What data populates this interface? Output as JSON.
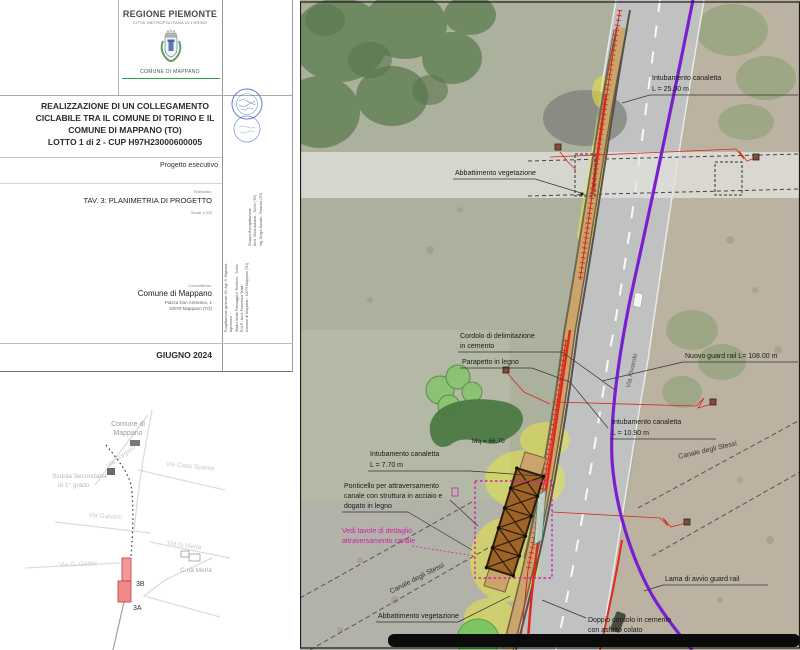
{
  "header": {
    "region": "REGIONE PIEMONTE",
    "metro": "CITTA' METROPOLITANA DI TORINO",
    "comune": "COMUNE DI MAPPANO"
  },
  "title": {
    "line1": "REALIZZAZIONE DI UN COLLEGAMENTO",
    "line2": "CICLABILE TRA IL COMUNE DI TORINO E IL",
    "line3": "COMUNE DI MAPPANO (TO)",
    "line4": "LOTTO 1 di 2 - CUP H97H23000600005",
    "phase": "Progetto esecutivo"
  },
  "elaborato": {
    "label": "Elaborato:",
    "value": "TAV. 3: PLANIMETRIA DI PROGETTO",
    "scale": "Scala 1:200"
  },
  "designers": {
    "right_block": "Gruppo di progettazione:\nArch. Silvia Adriano - Torino (TO)\nIng. Sergio Donato - Rivarolo (TO)",
    "left_block": "Progettazione generale: Dr. Agr. S. Mignone - Agronomo\nStudio Verde Paesaggio e Territorio - Torino\nR.U.P.: Arch. Francesca Testa\nComune di Mappano - 10079 Mappano (TO)"
  },
  "committente": {
    "label": "Committente:",
    "name": "Comune di Mappano",
    "address1": "Piazza Don Amerano, 1",
    "address2": "10079 Mappano (TO)"
  },
  "date": "GIUGNO 2024",
  "minimap": {
    "comune_1": "Comune di",
    "comune_2": "Mappano",
    "scuola_1": "Scuola Secondaria",
    "scuola_2": "di 1° grado",
    "via_borgaro": "Via Borgaro",
    "via_case_sparse": "Via Case Sparse",
    "via_galvani": "Via Galvani",
    "via_la_merla": "Via la Merla",
    "cna_merla": "C.na Merla",
    "via_galilei": "Via G. Galilei",
    "seg_3b": "3B",
    "seg_3a": "3A"
  },
  "plan": {
    "labels": {
      "intub25_1": "Intubamento canaletta",
      "intub25_2": "L = 25.00 m",
      "abbatt_top": "Abbattimento vegetazione",
      "cordolo_1": "Cordolo di delimitazione",
      "cordolo_2": "in cemento",
      "parapetto": "Parapetto in legno",
      "guardrail": "Nuovo guard rail L= 108.00 m",
      "intub1090_1": "Intubamento canaletta",
      "intub1090_2": "L = 10.90 m",
      "mq": "Mq = 66,70",
      "intub770_1": "Intubamento canaletta",
      "intub770_2": "L = 7.70 m",
      "pont_1": "Ponticello per attraversamento",
      "pont_2": "canale con struttura in acciaio e",
      "pont_3": "dogato in legno",
      "vedi_1": "Vedi tavole di dettaglio",
      "vedi_2": "attraversamento canale",
      "canale_left": "Canale degli Stessi",
      "canale_right": "Canale degli Stessi",
      "abbatt_bottom": "Abbattimento vegetazione",
      "lama": "Lama di avvio guard rail",
      "doppio_1": "Doppio cordolo in cemento",
      "doppio_2": "con asfalto colato",
      "via_rivarolo": "Via Rivarolo"
    },
    "colors": {
      "route_purple": "#7a1fd0",
      "canaletta_red": "#d42a1e",
      "detail_magenta": "#cc22aa",
      "path_tan": "#c9a56d",
      "highlight_yellow": "#e8e545"
    }
  }
}
